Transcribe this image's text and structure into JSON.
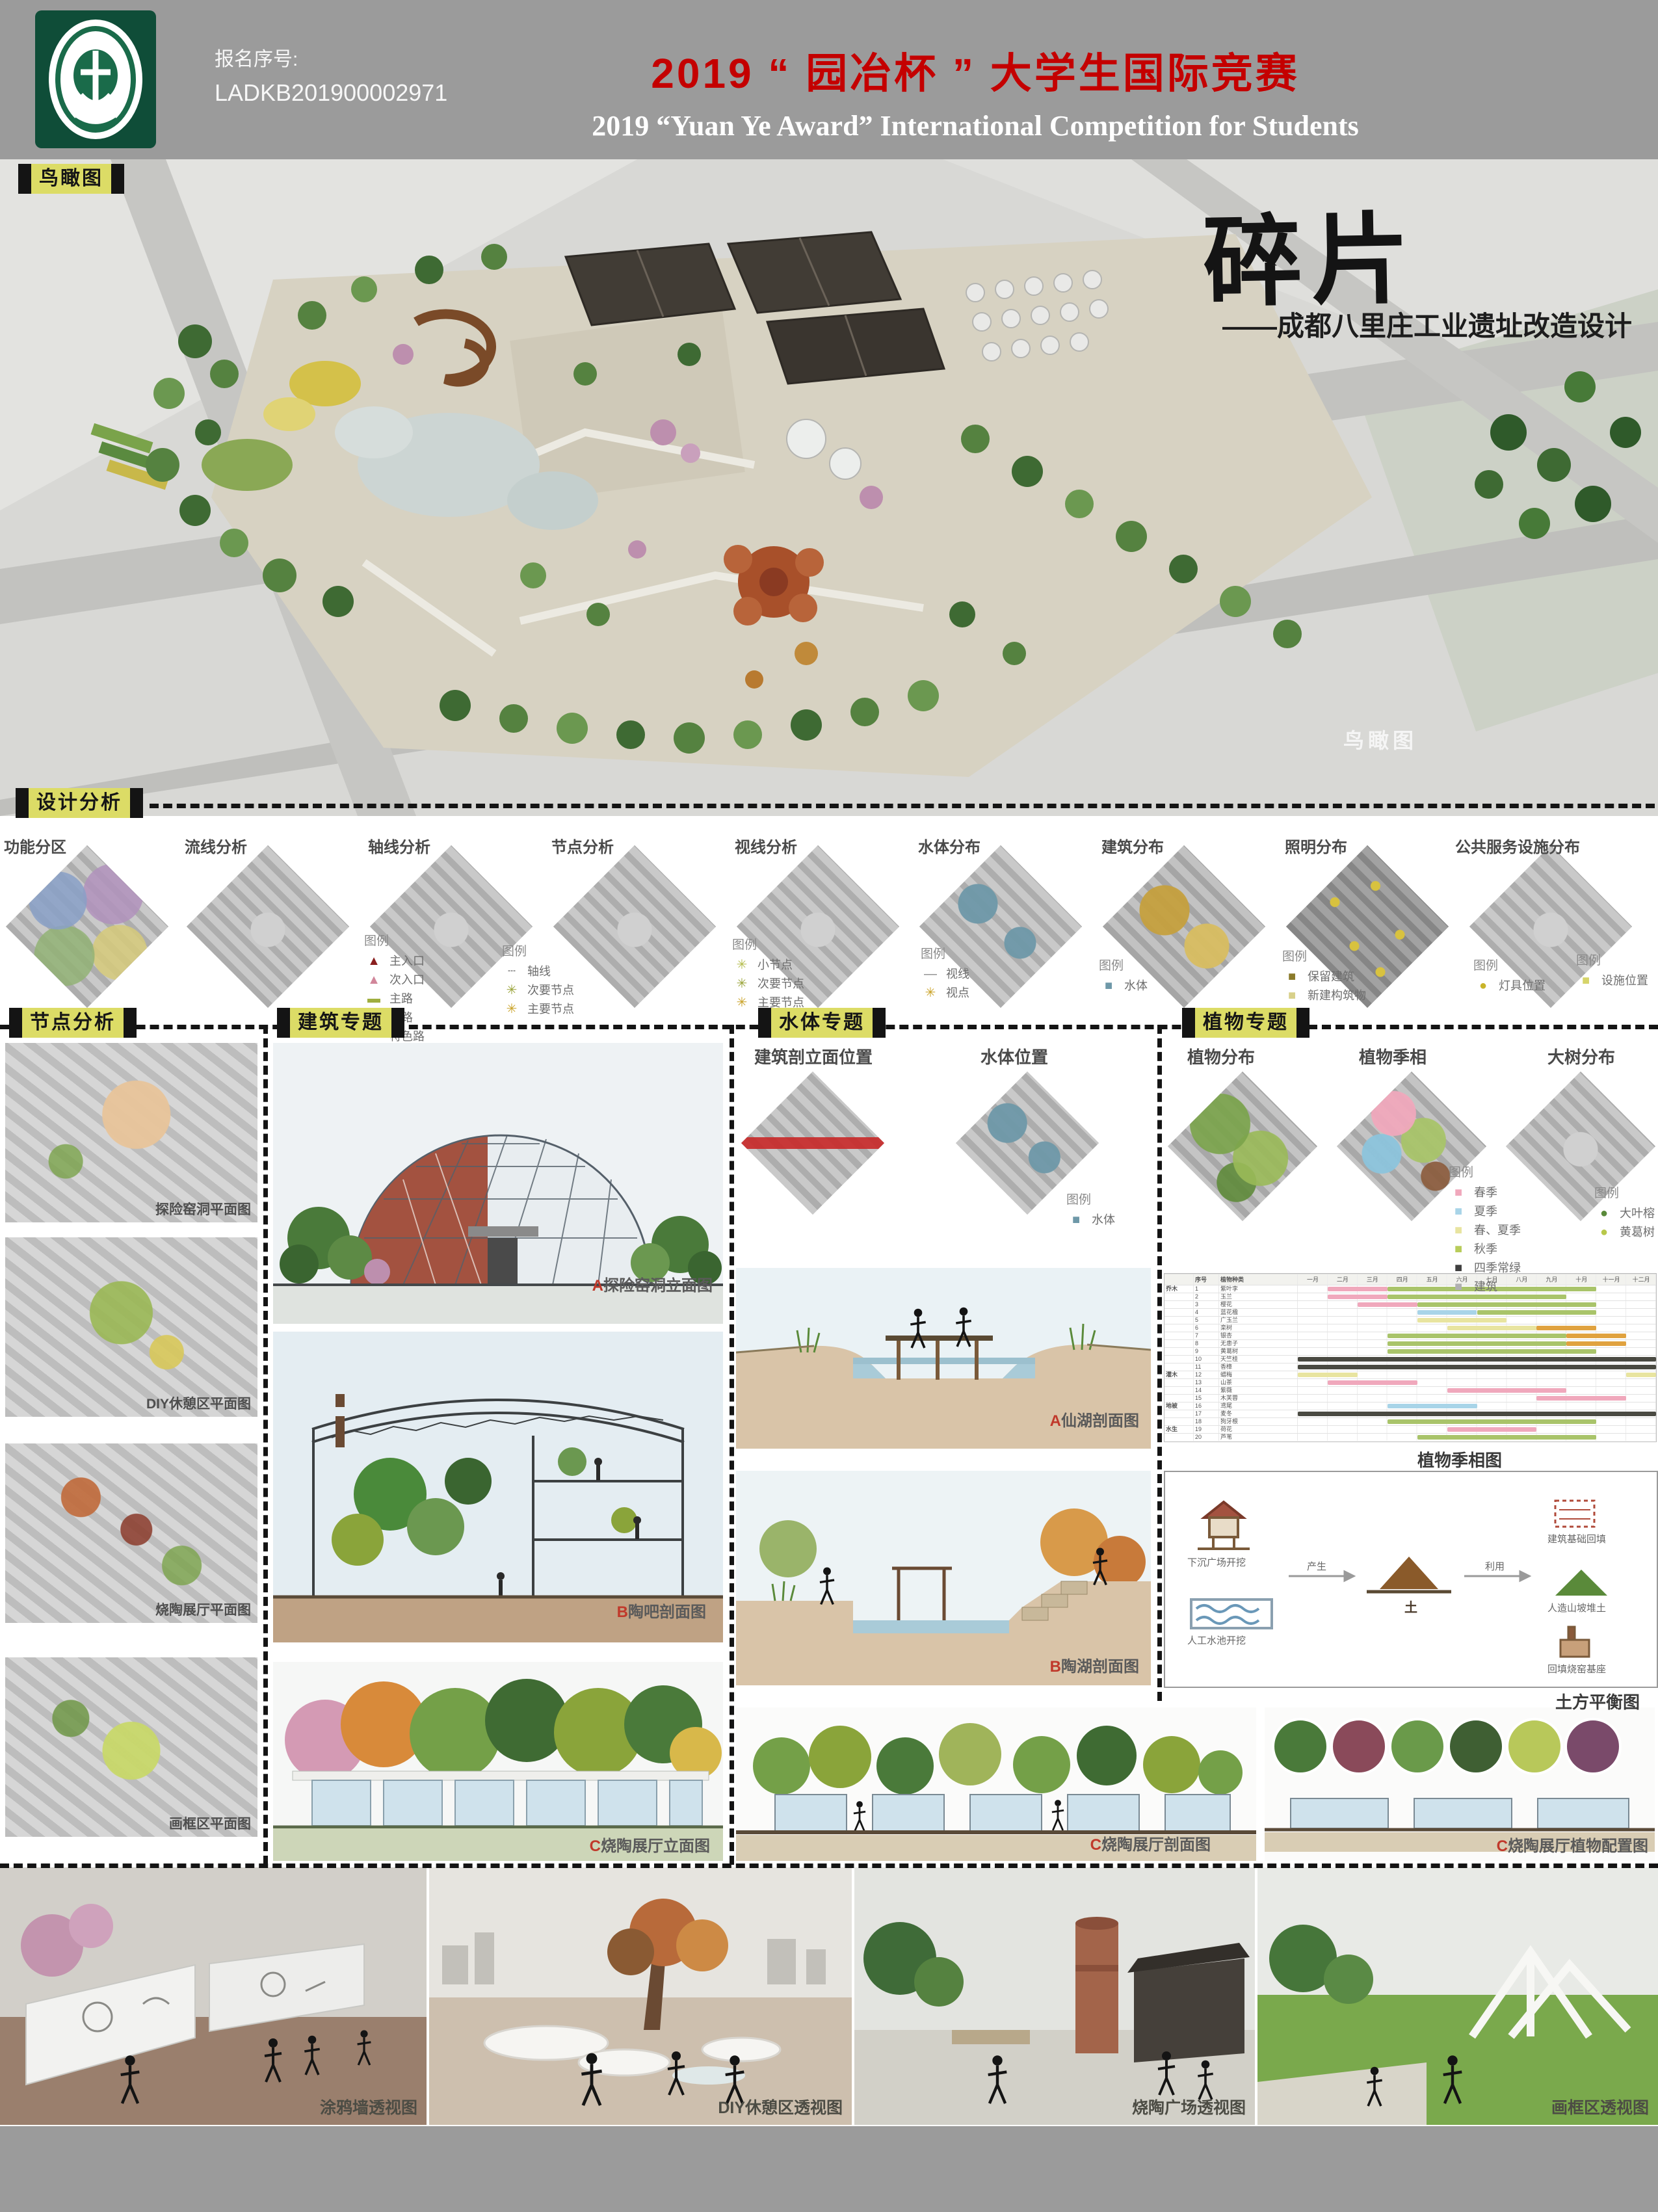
{
  "header": {
    "reg_label": "报名序号:",
    "reg_number": "LADKB201900002971",
    "title_cn": "2019 “ 园冶杯 ” 大学生国际竞赛",
    "title_en": "2019 “Yuan Ye Award” International Competition for  Students"
  },
  "project": {
    "title": "碎片",
    "subtitle": "——成都八里庄工业遗址改造设计"
  },
  "aerial": {
    "tag": "鸟瞰图",
    "caption": "鸟瞰图"
  },
  "design_analysis": {
    "tag": "设计分析",
    "plans": [
      {
        "label": "功能分区",
        "legend": {
          "title": "",
          "items": []
        }
      },
      {
        "label": "流线分析",
        "legend": {
          "title": "图例",
          "items": [
            {
              "glyph": "▲",
              "color": "#8a1f1f",
              "text": "主入口"
            },
            {
              "glyph": "▲",
              "color": "#d1869a",
              "text": "次入口"
            },
            {
              "glyph": "▬",
              "color": "#9fae3f",
              "text": "主路"
            },
            {
              "glyph": "—",
              "color": "#cdd98a",
              "text": "次路"
            },
            {
              "glyph": "—",
              "color": "#e8a0b0",
              "text": "特色路"
            }
          ]
        }
      },
      {
        "label": "轴线分析",
        "legend": {
          "title": "图例",
          "items": [
            {
              "glyph": "┄",
              "color": "#8a8a8a",
              "text": "轴线"
            },
            {
              "glyph": "✳",
              "color": "#9aa43a",
              "text": "次要节点"
            },
            {
              "glyph": "✳",
              "color": "#c9a227",
              "text": "主要节点"
            }
          ]
        }
      },
      {
        "label": "节点分析",
        "legend": {
          "title": "图例",
          "items": [
            {
              "glyph": "✳",
              "color": "#b5bd4e",
              "text": "小节点"
            },
            {
              "glyph": "✳",
              "color": "#9aa43a",
              "text": "次要节点"
            },
            {
              "glyph": "✳",
              "color": "#c9a227",
              "text": "主要节点"
            }
          ]
        }
      },
      {
        "label": "视线分析",
        "legend": {
          "title": "图例",
          "items": [
            {
              "glyph": "—",
              "color": "#8a8a8a",
              "text": "视线"
            },
            {
              "glyph": "✳",
              "color": "#c9a227",
              "text": "视点"
            }
          ]
        }
      },
      {
        "label": "水体分布",
        "legend": {
          "title": "图例",
          "items": [
            {
              "glyph": "■",
              "color": "#6e98a8",
              "text": "水体"
            }
          ]
        }
      },
      {
        "label": "建筑分布",
        "legend": {
          "title": "图例",
          "items": [
            {
              "glyph": "■",
              "color": "#8a7a2a",
              "text": "保留建筑"
            },
            {
              "glyph": "■",
              "color": "#d8d08a",
              "text": "新建构筑物"
            }
          ]
        }
      },
      {
        "label": "照明分布",
        "legend": {
          "title": "图例",
          "items": [
            {
              "glyph": "●",
              "color": "#c9b42a",
              "text": "灯具位置"
            }
          ]
        }
      },
      {
        "label": "公共服务设施分布",
        "legend": {
          "title": "图例",
          "items": [
            {
              "glyph": "■",
              "color": "#d6d46a",
              "text": "设施位置"
            }
          ]
        }
      }
    ]
  },
  "node_analysis": {
    "tag": "节点分析",
    "items": [
      {
        "caption": "探险窑洞平面图"
      },
      {
        "caption": "DIY休憩区平面图"
      },
      {
        "caption": "烧陶展厅平面图"
      },
      {
        "caption": "画框区平面图"
      }
    ]
  },
  "architecture": {
    "tag": "建筑专题",
    "items": [
      {
        "caption": "A探险窑洞立面图"
      },
      {
        "caption": "B陶吧剖面图"
      },
      {
        "caption": "C烧陶展厅立面图"
      }
    ]
  },
  "water": {
    "tag": "水体专题",
    "plan_labels": [
      "建筑剖立面位置",
      "水体位置"
    ],
    "legend": {
      "title": "图例",
      "items": [
        {
          "glyph": "■",
          "color": "#6e98a8",
          "text": "水体"
        }
      ]
    },
    "items": [
      {
        "caption": "A仙湖剖面图"
      },
      {
        "caption": "B陶湖剖面图"
      },
      {
        "caption": "C烧陶展厅剖面图"
      }
    ]
  },
  "plants": {
    "tag": "植物专题",
    "plan_labels": [
      "植物分布",
      "植物季相",
      "大树分布"
    ],
    "season_legend": {
      "title": "图例",
      "items": [
        {
          "glyph": "■",
          "color": "#f0a8bc",
          "text": "春季"
        },
        {
          "glyph": "■",
          "color": "#a8d4e8",
          "text": "夏季"
        },
        {
          "glyph": "■",
          "color": "#e8e4a0",
          "text": "春、夏季"
        },
        {
          "glyph": "■",
          "color": "#b8cc5a",
          "text": "秋季"
        },
        {
          "glyph": "■",
          "color": "#3f3f3f",
          "text": "四季常绿"
        },
        {
          "glyph": "■",
          "color": "#b0b0b0",
          "text": "建筑"
        }
      ]
    },
    "tree_legend": {
      "title": "图例",
      "items": [
        {
          "glyph": "●",
          "color": "#5a8a3a",
          "text": "大叶榕"
        },
        {
          "glyph": "●",
          "color": "#b8c84a",
          "text": "黄葛树"
        }
      ]
    },
    "calendar_caption": "植物季相图",
    "earthwork_caption": "土方平衡图",
    "config_caption": "C烧陶展厅植物配置图",
    "earthwork": {
      "left": [
        "下沉广场开挖",
        "人工水池开挖"
      ],
      "arrow1": "产生",
      "center": "土",
      "arrow2": "利用",
      "right": [
        "建筑基础回填",
        "人造山坡堆土",
        "回填烧窑基座"
      ]
    }
  },
  "perspectives": [
    {
      "caption": "涂鸦墙透视图"
    },
    {
      "caption": "DIY休憩区透视图"
    },
    {
      "caption": "烧陶广场透视图"
    },
    {
      "caption": "画框区透视图"
    }
  ],
  "chart_data": {
    "type": "table",
    "title": "植物季相图",
    "columns": [
      "序号",
      "植物种类"
    ],
    "months": [
      "一月",
      "二月",
      "三月",
      "四月",
      "五月",
      "六月",
      "七月",
      "八月",
      "九月",
      "十月",
      "十一月",
      "十二月"
    ],
    "palette": {
      "spring": "#f0a8bc",
      "summer": "#a9c46a",
      "blue": "#a8d4e8",
      "pale": "#e8e4a0",
      "autumn": "#e0a23f",
      "evergreen": "#4a4a42"
    },
    "groups": [
      {
        "name": "乔木",
        "rows": [
          {
            "no": "1",
            "name": "紫叶李",
            "bars": [
              [
                2,
                3,
                "spring"
              ],
              [
                4,
                10,
                "summer"
              ]
            ]
          },
          {
            "no": "2",
            "name": "玉兰",
            "bars": [
              [
                2,
                3,
                "spring"
              ],
              [
                4,
                9,
                "summer"
              ]
            ]
          },
          {
            "no": "3",
            "name": "樱花",
            "bars": [
              [
                3,
                4,
                "spring"
              ],
              [
                5,
                10,
                "summer"
              ]
            ]
          },
          {
            "no": "4",
            "name": "蓝花楹",
            "bars": [
              [
                5,
                6,
                "blue"
              ],
              [
                7,
                10,
                "summer"
              ]
            ]
          },
          {
            "no": "5",
            "name": "广玉兰",
            "bars": [
              [
                5,
                7,
                "pale"
              ]
            ]
          },
          {
            "no": "6",
            "name": "栾树",
            "bars": [
              [
                6,
                8,
                "pale"
              ],
              [
                9,
                10,
                "autumn"
              ]
            ]
          },
          {
            "no": "7",
            "name": "银杏",
            "bars": [
              [
                4,
                9,
                "summer"
              ],
              [
                10,
                11,
                "autumn"
              ]
            ]
          },
          {
            "no": "8",
            "name": "无患子",
            "bars": [
              [
                4,
                9,
                "summer"
              ],
              [
                10,
                11,
                "autumn"
              ]
            ]
          },
          {
            "no": "9",
            "name": "黄葛树",
            "bars": [
              [
                4,
                10,
                "summer"
              ]
            ]
          },
          {
            "no": "10",
            "name": "天竺桂",
            "bars": [
              [
                1,
                12,
                "evergreen"
              ]
            ]
          },
          {
            "no": "11",
            "name": "香樟",
            "bars": [
              [
                1,
                12,
                "evergreen"
              ]
            ]
          }
        ]
      },
      {
        "name": "灌木",
        "rows": [
          {
            "no": "12",
            "name": "蜡梅",
            "bars": [
              [
                1,
                2,
                "pale"
              ],
              [
                12,
                12,
                "pale"
              ]
            ]
          },
          {
            "no": "13",
            "name": "山茶",
            "bars": [
              [
                2,
                4,
                "spring"
              ]
            ]
          },
          {
            "no": "14",
            "name": "紫薇",
            "bars": [
              [
                6,
                9,
                "spring"
              ]
            ]
          },
          {
            "no": "15",
            "name": "木芙蓉",
            "bars": [
              [
                9,
                11,
                "spring"
              ]
            ]
          }
        ]
      },
      {
        "name": "地被",
        "rows": [
          {
            "no": "16",
            "name": "鸢尾",
            "bars": [
              [
                4,
                6,
                "blue"
              ]
            ]
          },
          {
            "no": "17",
            "name": "麦冬",
            "bars": [
              [
                1,
                12,
                "evergreen"
              ]
            ]
          },
          {
            "no": "18",
            "name": "狗牙根",
            "bars": [
              [
                4,
                10,
                "summer"
              ]
            ]
          }
        ]
      },
      {
        "name": "水生",
        "rows": [
          {
            "no": "19",
            "name": "荷花",
            "bars": [
              [
                6,
                8,
                "spring"
              ]
            ]
          },
          {
            "no": "20",
            "name": "芦苇",
            "bars": [
              [
                5,
                10,
                "summer"
              ]
            ]
          }
        ]
      }
    ]
  }
}
